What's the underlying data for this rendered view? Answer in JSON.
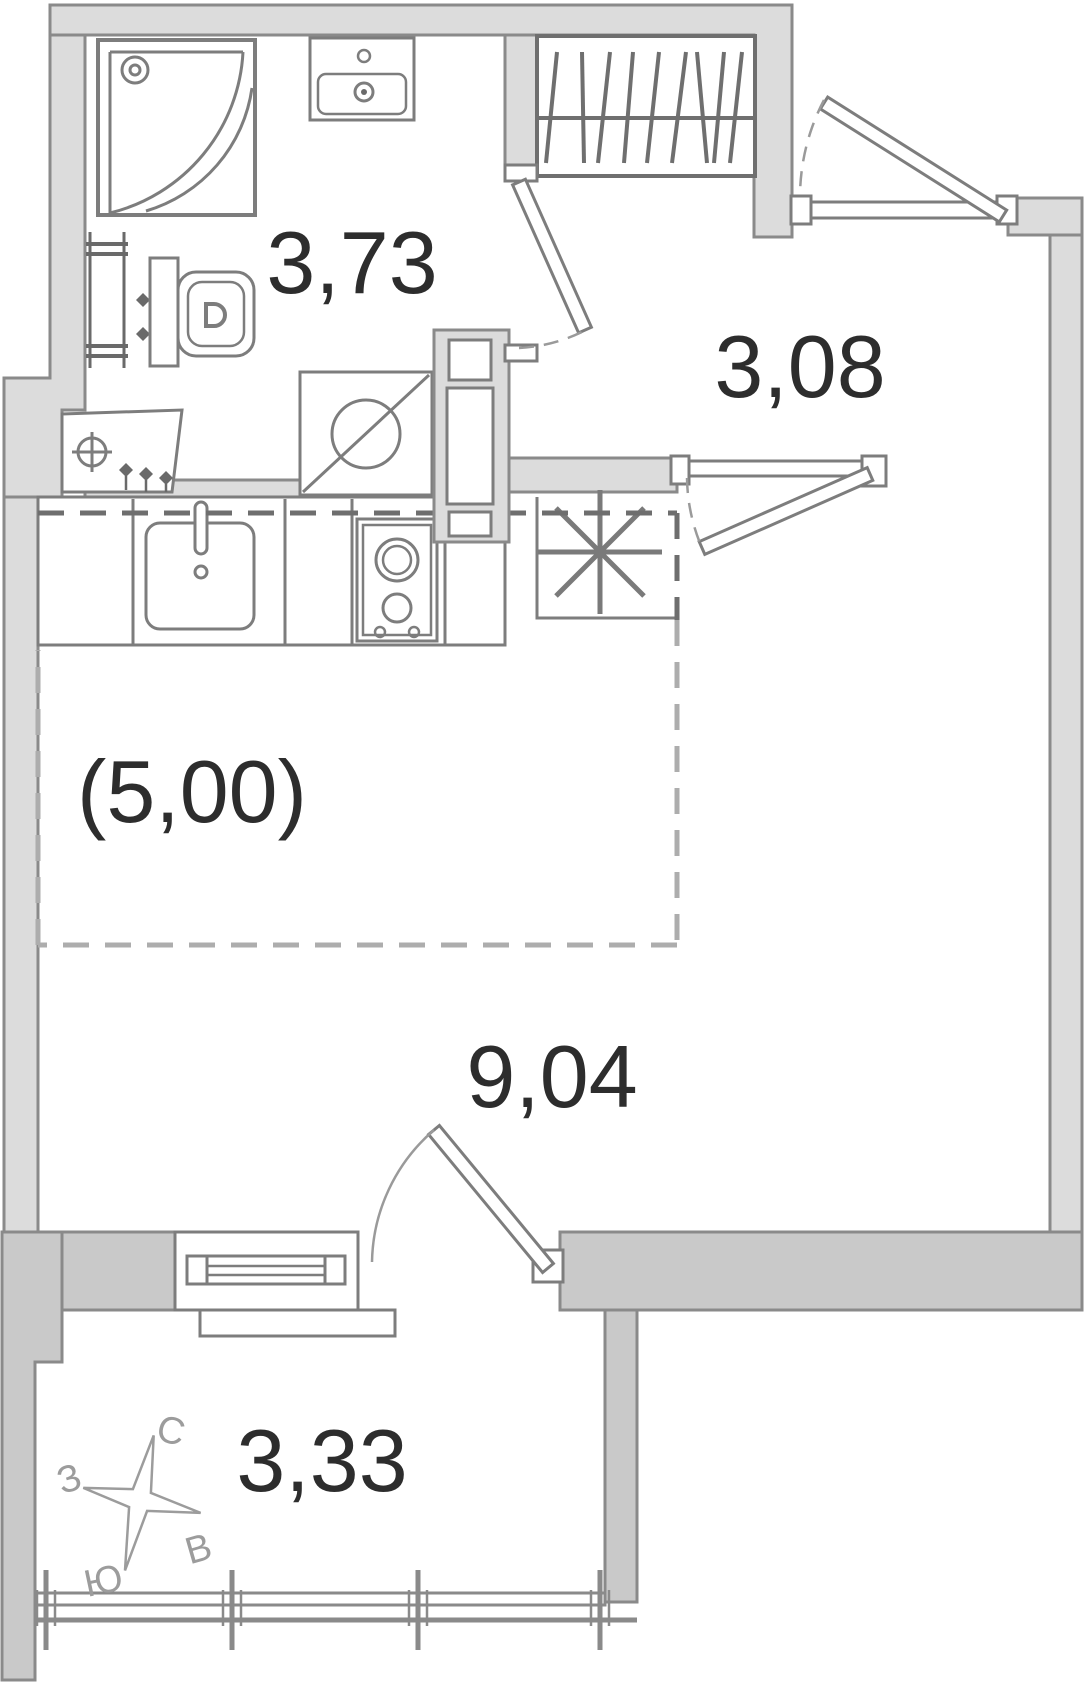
{
  "plan": {
    "rooms": {
      "bathroom": {
        "label": "3,73"
      },
      "hallway": {
        "label": "3,08"
      },
      "kitchen_zone": {
        "label": "(5,00)"
      },
      "living_room": {
        "label": "9,04"
      },
      "balcony": {
        "label": "3,33"
      }
    },
    "compass": {
      "north": "С",
      "west": "З",
      "east": "В",
      "south": "Ю"
    },
    "colors": {
      "wall_fill": "#dcdcdc",
      "wall_fill_dark": "#c9c9c9",
      "wall_outline": "#8a8a8a",
      "fixture_stroke": "#7d7d7d",
      "fixture_dark": "#6a6a6a",
      "dash_dark": "#6e6e6e",
      "dash_light": "#adadad",
      "label_text": "#2d2d2d",
      "compass_text": "#9c9c9c",
      "background": "#ffffff"
    }
  }
}
